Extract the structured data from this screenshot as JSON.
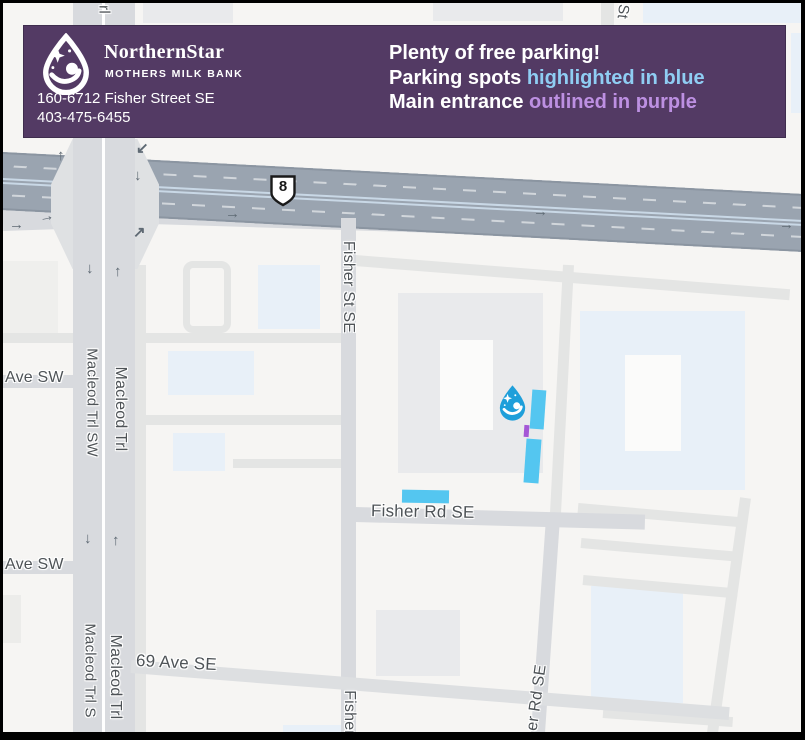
{
  "theme": {
    "banner_bg": "#533a64",
    "banner_border": "#3f2d4e",
    "text_white": "#ffffff",
    "highlight_blue": "#8fcdf3",
    "highlight_purple": "#bd90e2",
    "parking_blue": "#54c6f0",
    "entrance_purple": "#a457d6",
    "marker_blue": "#1f9fda",
    "map_bg": "#f6f5f3",
    "highway_gray": "#9aa4b0",
    "road_major": "#d8dade",
    "road_minor": "#e4e5e4",
    "building_gray": "#e9eaec",
    "building_blue": "#e8f0f8",
    "label_gray": "#4e5357",
    "arrow_gray": "#5f6a74"
  },
  "banner": {
    "brand_name": "NorthernStar",
    "brand_subtitle": "MOTHERS MILK BANK",
    "address_line1": "160-6712 Fisher Street SE",
    "address_line2": "403-475-6455",
    "message_line1": "Plenty of free parking!",
    "message_line2_prefix": "Parking spots ",
    "message_line2_highlight": "highlighted in blue",
    "message_line3_prefix": "Main entrance ",
    "message_line3_highlight": "outlined in purple"
  },
  "map": {
    "route_shield": "8",
    "labels": {
      "street_fragment_top_left": "rl",
      "street_fragment_top_right": "St",
      "fisher_st_se": "Fisher St SE",
      "ave_sw_upper": "Ave SW",
      "ave_sw_lower": "Ave SW",
      "macleod_trl_sw": "Macleod Trl SW",
      "macleod_trl_upper": "Macleod Trl",
      "macleod_trl_s_lower": "Macleod Trl S",
      "macleod_trl_lower": "Macleod Trl",
      "fisher_rd_se": "Fisher Rd SE",
      "sixty_nine_ave_se": "69 Ave SE",
      "fisher_partial_bottom": "Fisher",
      "fisher_rd_partial": "er Rd SE"
    },
    "icons": {
      "arrow_up": "↑",
      "arrow_down": "↓",
      "arrow_right": "→",
      "arrow_up_right": "↗",
      "arrow_down_left": "↙"
    }
  }
}
